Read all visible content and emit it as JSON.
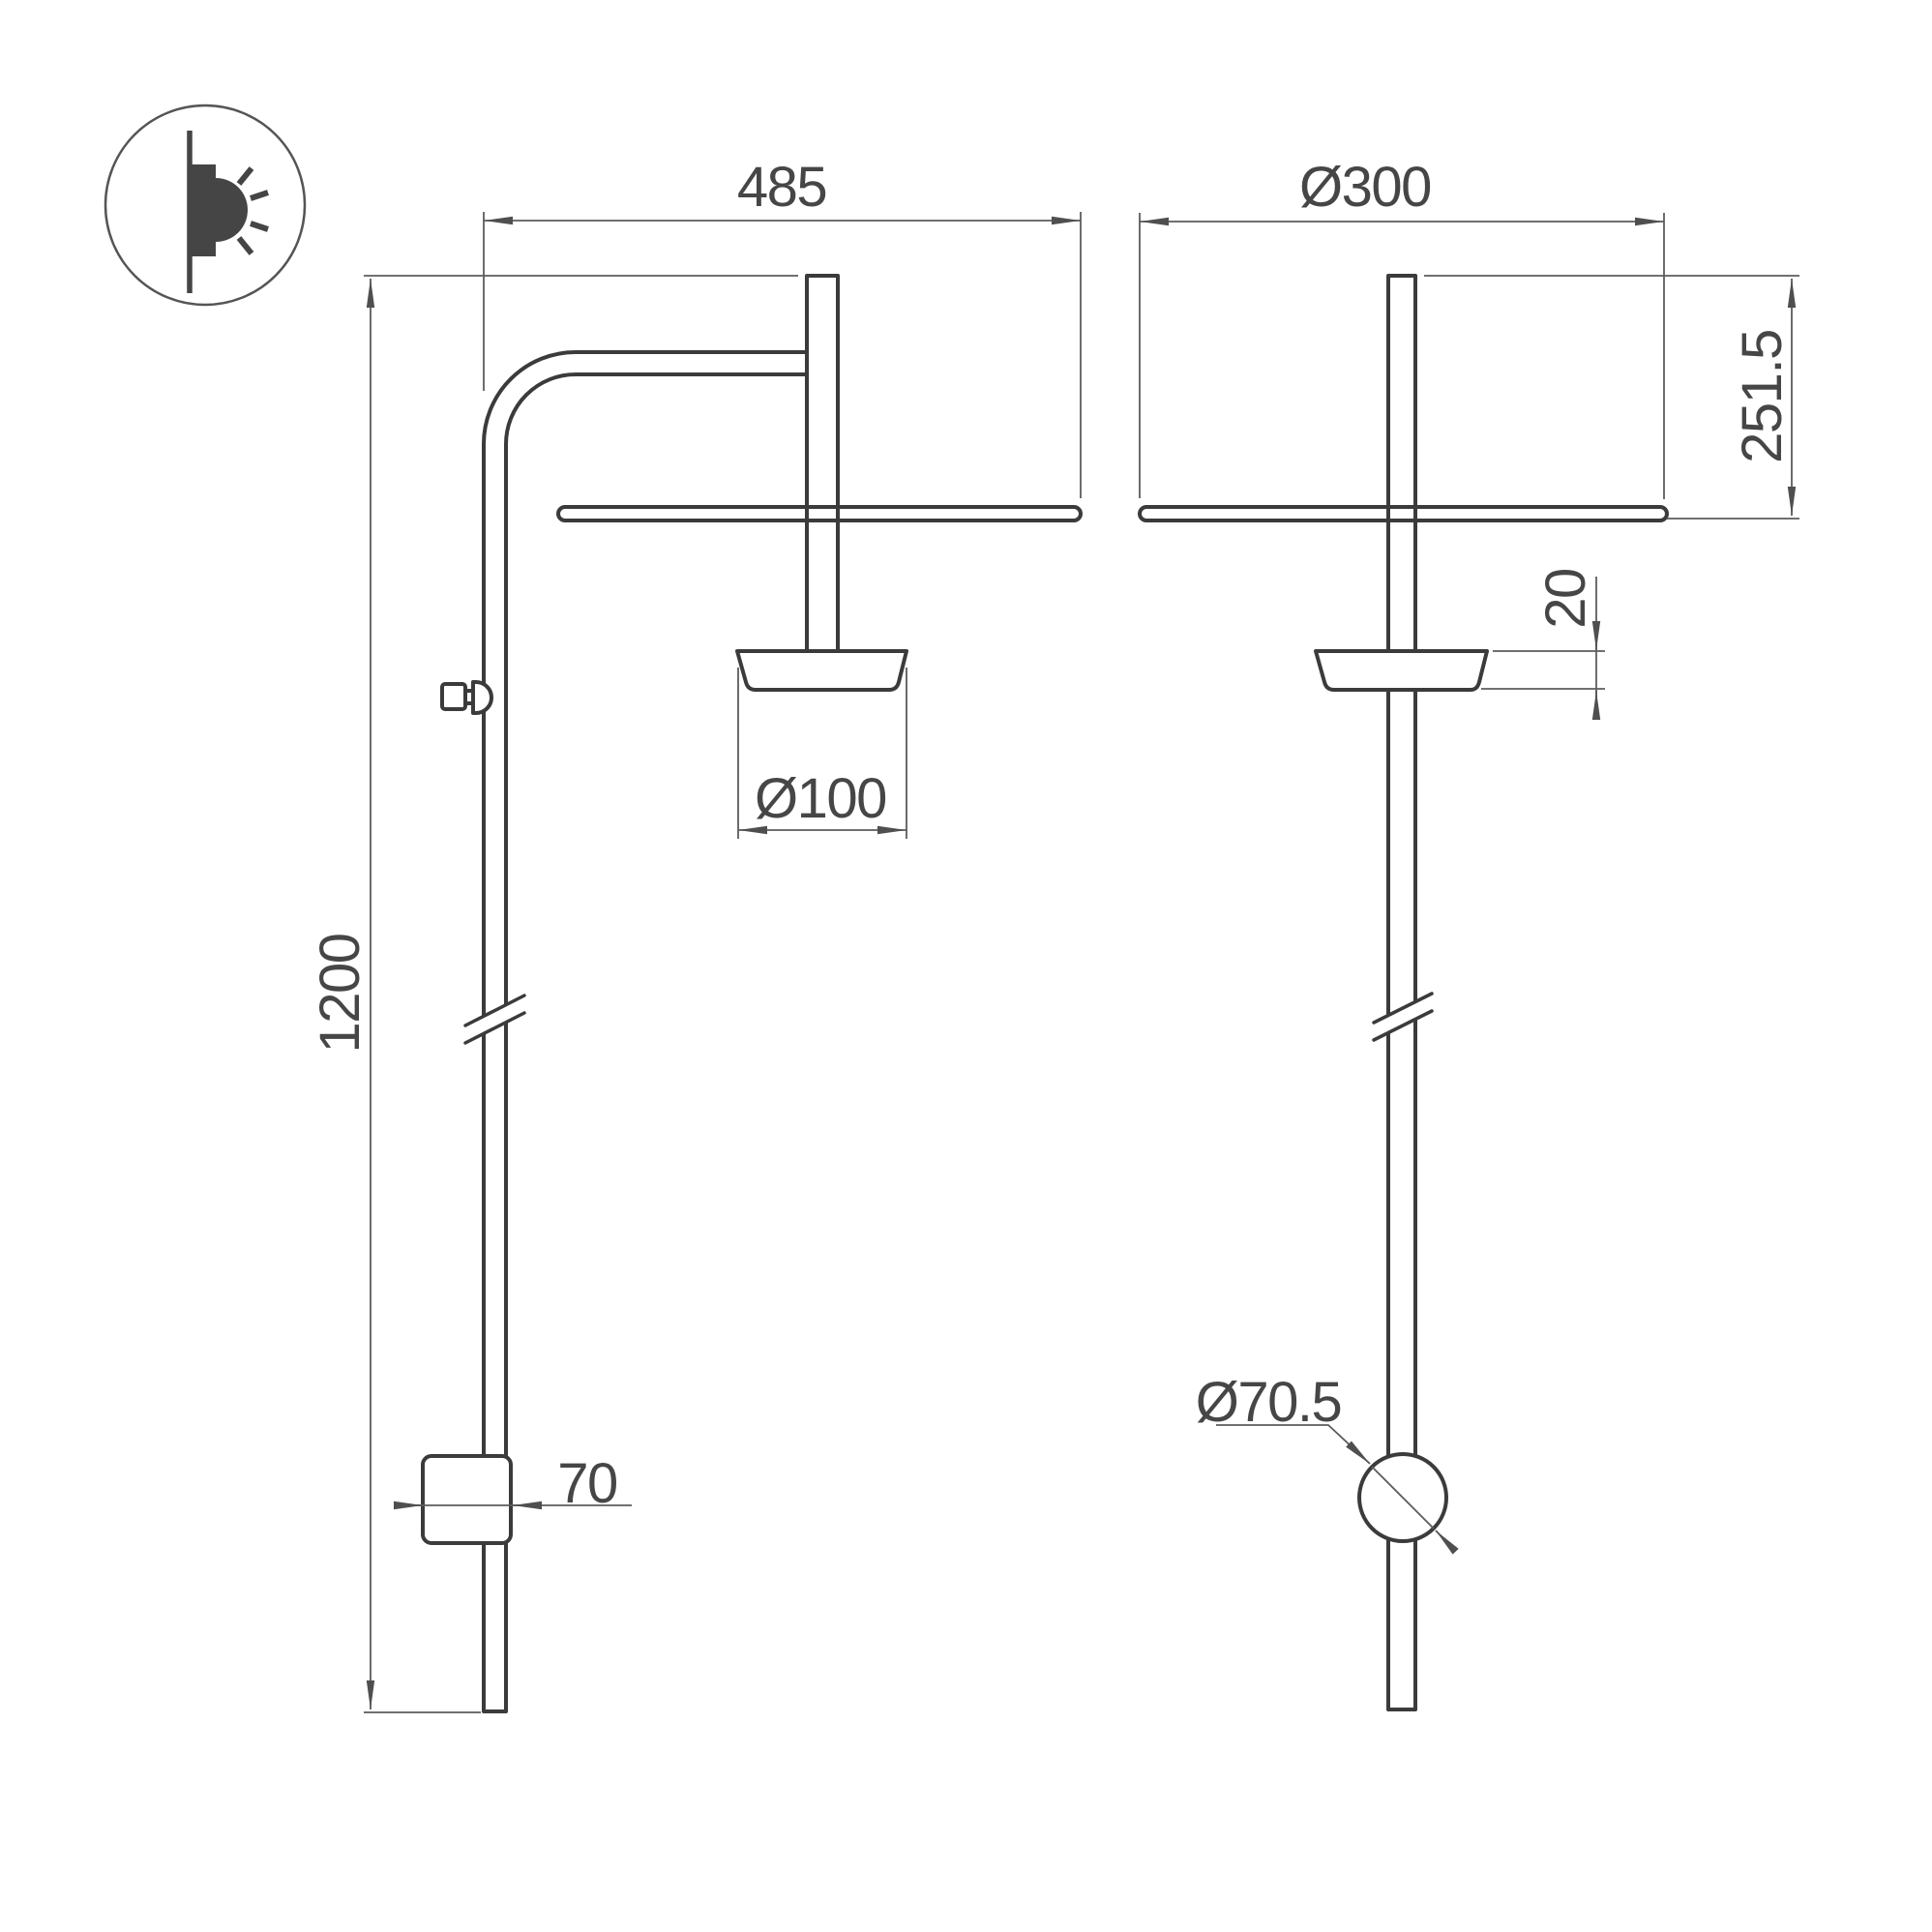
{
  "drawing": {
    "kind": "wall-lamp-dimension-drawing",
    "icon": "wall-light-icon",
    "side_view": {
      "arm_reach": "485",
      "total_height": "1200",
      "spot_diameter": "Ø100",
      "wall_box_size": "70"
    },
    "front_view": {
      "shade_diameter": "Ø300",
      "top_to_shade_depth": "251.5",
      "holder_height": "20",
      "knob_diameter": "Ø70.5"
    },
    "colors": {
      "background": "#ffffff",
      "object_line": "#3b3b3b",
      "dimension_line": "#5c5c5c",
      "text": "#464646"
    }
  }
}
